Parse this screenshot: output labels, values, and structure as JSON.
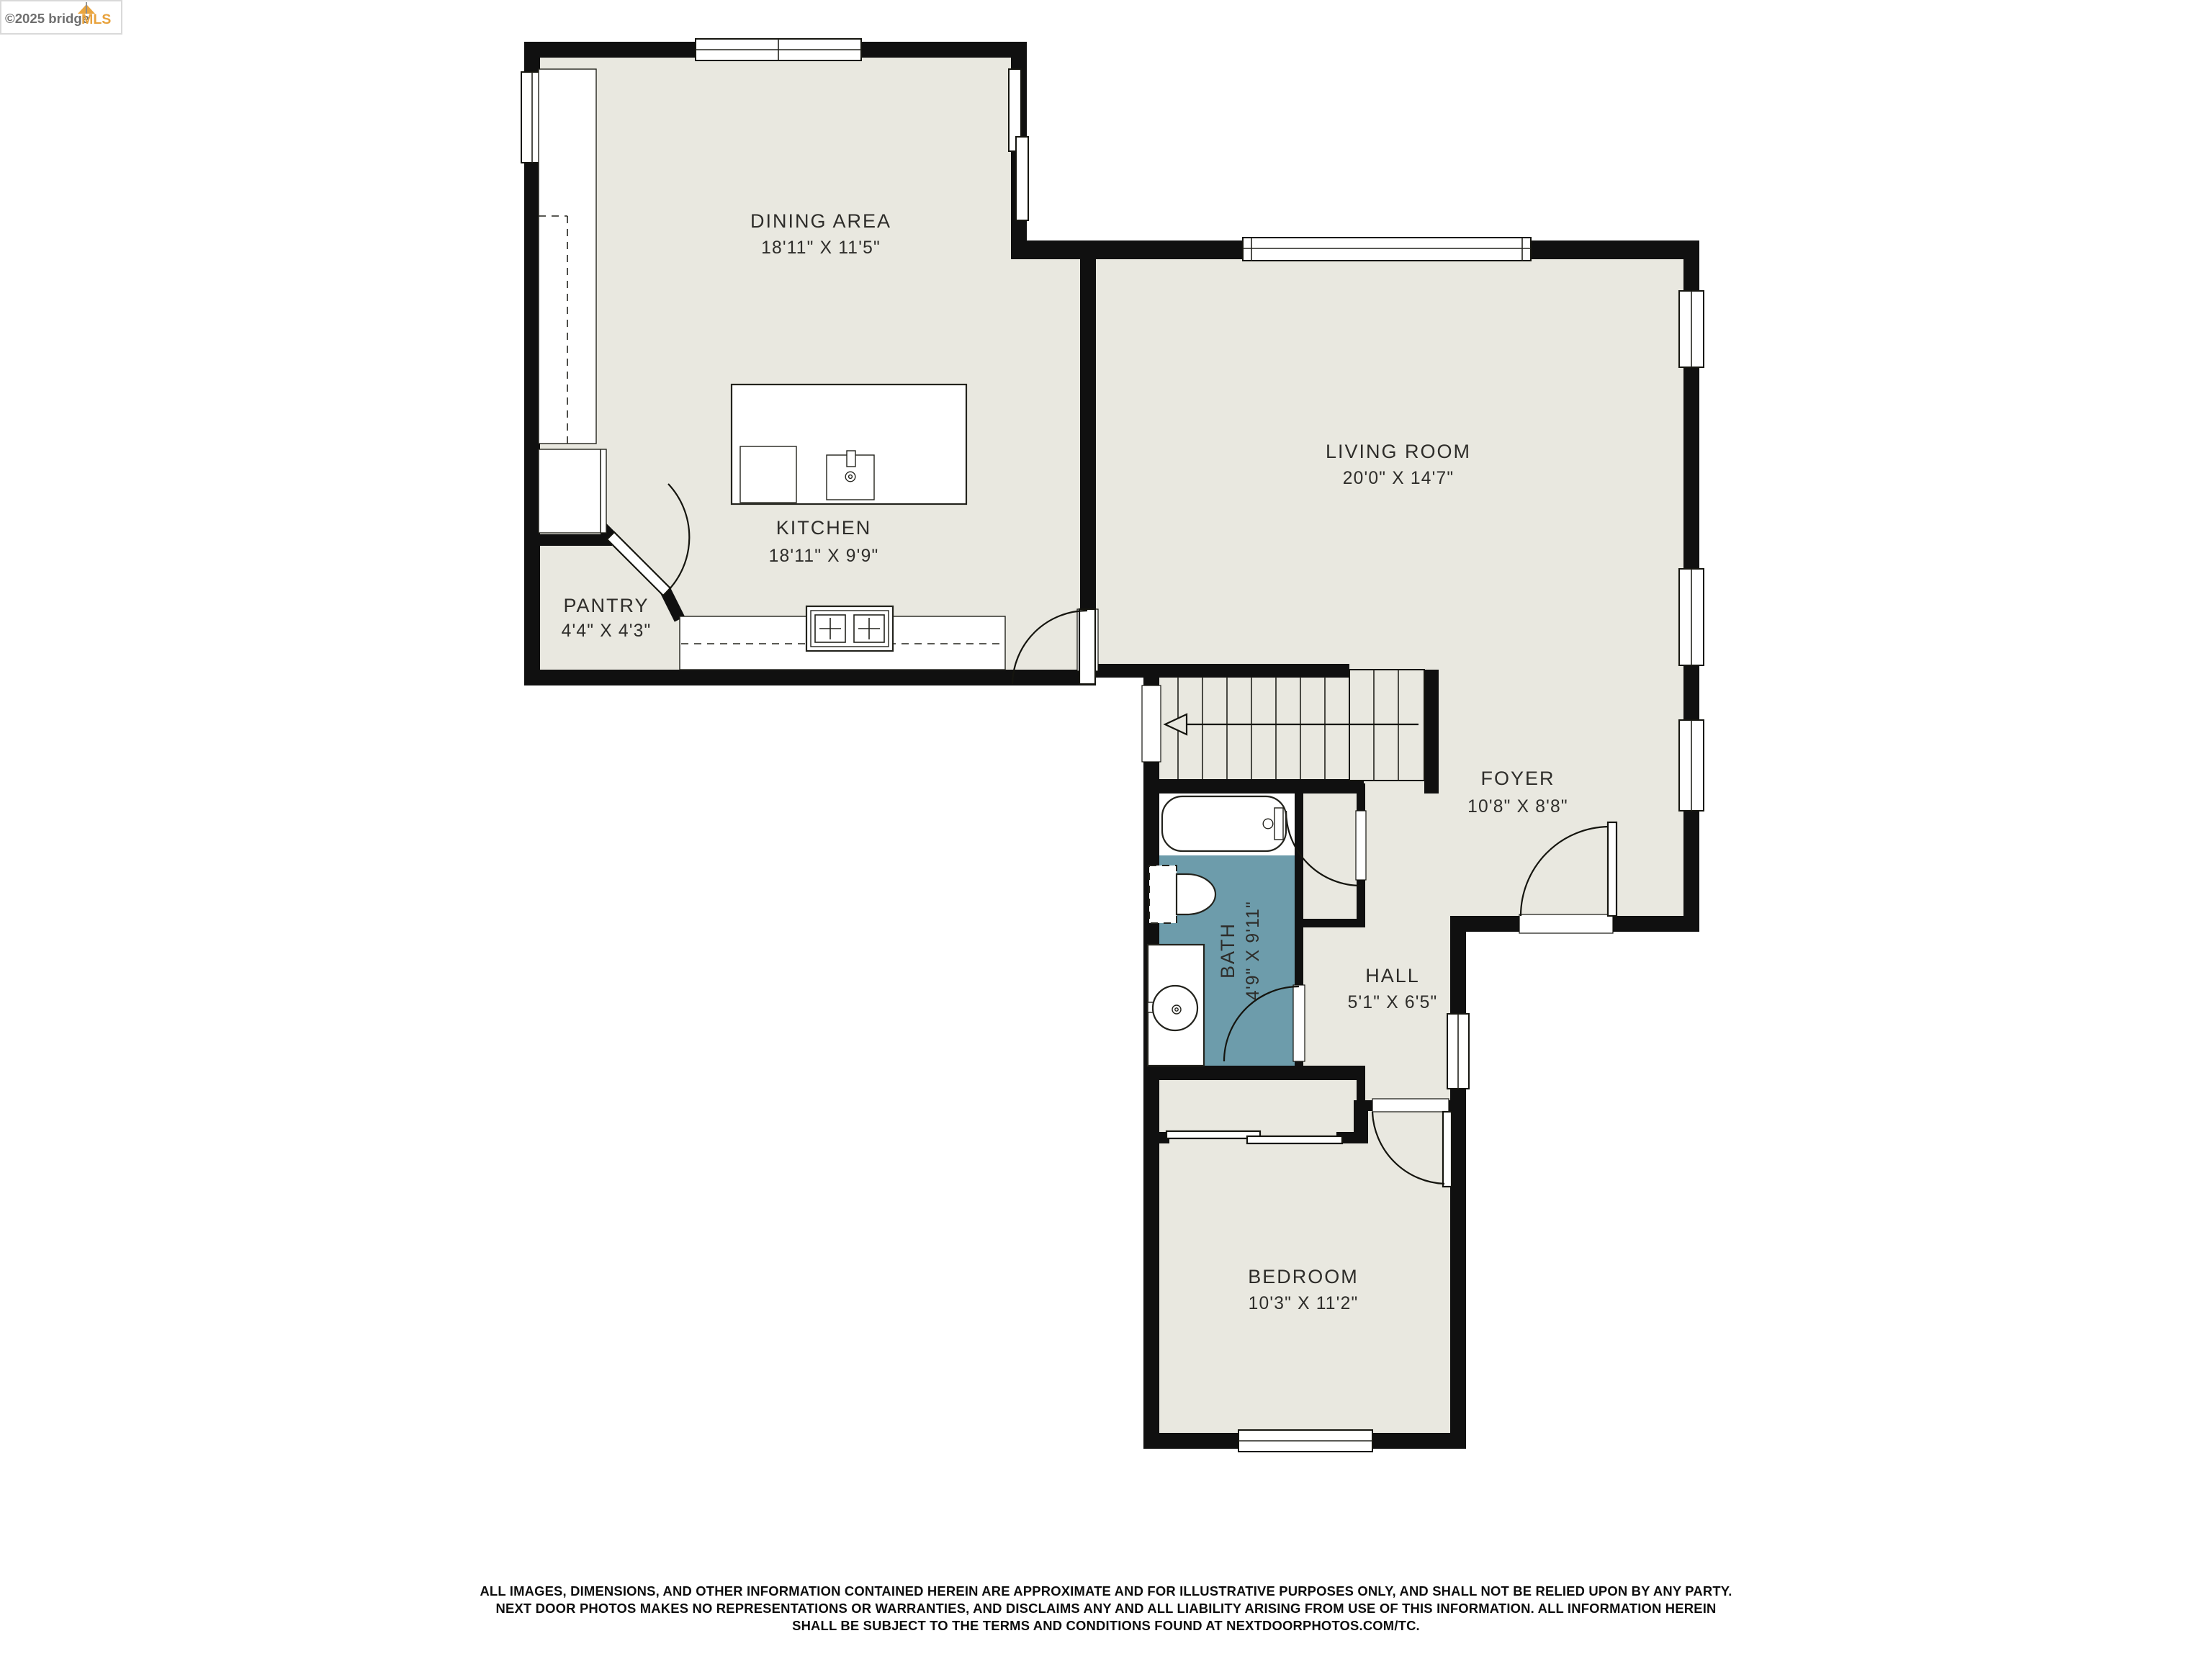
{
  "branding": {
    "copyright": "©2025 bridge",
    "mls": "MLS"
  },
  "rooms": [
    {
      "id": "dining",
      "name": "DINING AREA",
      "dims": "18'11\" X 11'5\""
    },
    {
      "id": "kitchen",
      "name": "KITCHEN",
      "dims": "18'11\" X 9'9\""
    },
    {
      "id": "pantry",
      "name": "PANTRY",
      "dims": "4'4\" X 4'3\""
    },
    {
      "id": "living",
      "name": "LIVING ROOM",
      "dims": "20'0\" X 14'7\""
    },
    {
      "id": "foyer",
      "name": "FOYER",
      "dims": "10'8\" X 8'8\""
    },
    {
      "id": "hall",
      "name": "HALL",
      "dims": "5'1\" X 6'5\""
    },
    {
      "id": "bath",
      "name": "BATH",
      "dims": "4'9\" X 9'11\""
    },
    {
      "id": "bedroom",
      "name": "BEDROOM",
      "dims": "10'3\" X 11'2\""
    }
  ],
  "disclaimer": {
    "line1": "ALL IMAGES, DIMENSIONS, AND OTHER INFORMATION CONTAINED HEREIN ARE APPROXIMATE AND FOR ILLUSTRATIVE PURPOSES ONLY, AND SHALL NOT BE RELIED UPON BY ANY PARTY.",
    "line2": "NEXT DOOR PHOTOS MAKES NO REPRESENTATIONS OR WARRANTIES, AND DISCLAIMS ANY AND ALL LIABILITY ARISING FROM USE OF THIS INFORMATION. ALL INFORMATION HEREIN",
    "line3": "SHALL BE SUBJECT TO THE TERMS AND CONDITIONS FOUND AT NEXTDOORPHOTOS.COM/TC."
  },
  "colors": {
    "floor": "#e9e8e0",
    "bath_floor": "#6d9cab",
    "wall": "#101010",
    "label_text": "#2e2d2a",
    "logo_orange": "#e8a23c",
    "logo_gray": "#6f6f6f"
  }
}
